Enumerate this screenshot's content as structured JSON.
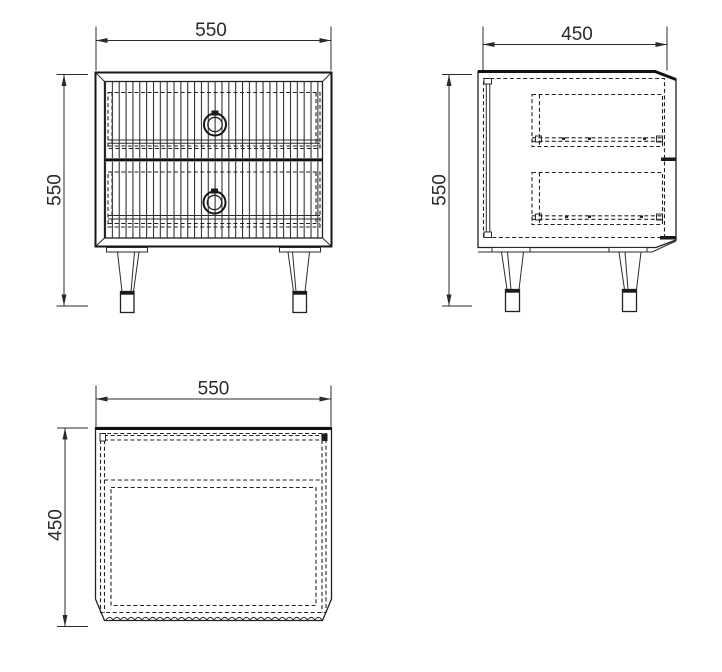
{
  "drawing": {
    "subject": "two-drawer nightstand orthographic views",
    "view_count": 3
  },
  "views": {
    "front": {
      "name": "front-view",
      "width_label": "550",
      "height_label": "550"
    },
    "side": {
      "name": "side-view",
      "depth_label": "450",
      "height_label": "550"
    },
    "top": {
      "name": "top-view",
      "width_label": "550",
      "depth_label": "450"
    }
  },
  "colors": {
    "line": "#222222",
    "dim_text": "#2b2b2b",
    "background": "#ffffff"
  }
}
